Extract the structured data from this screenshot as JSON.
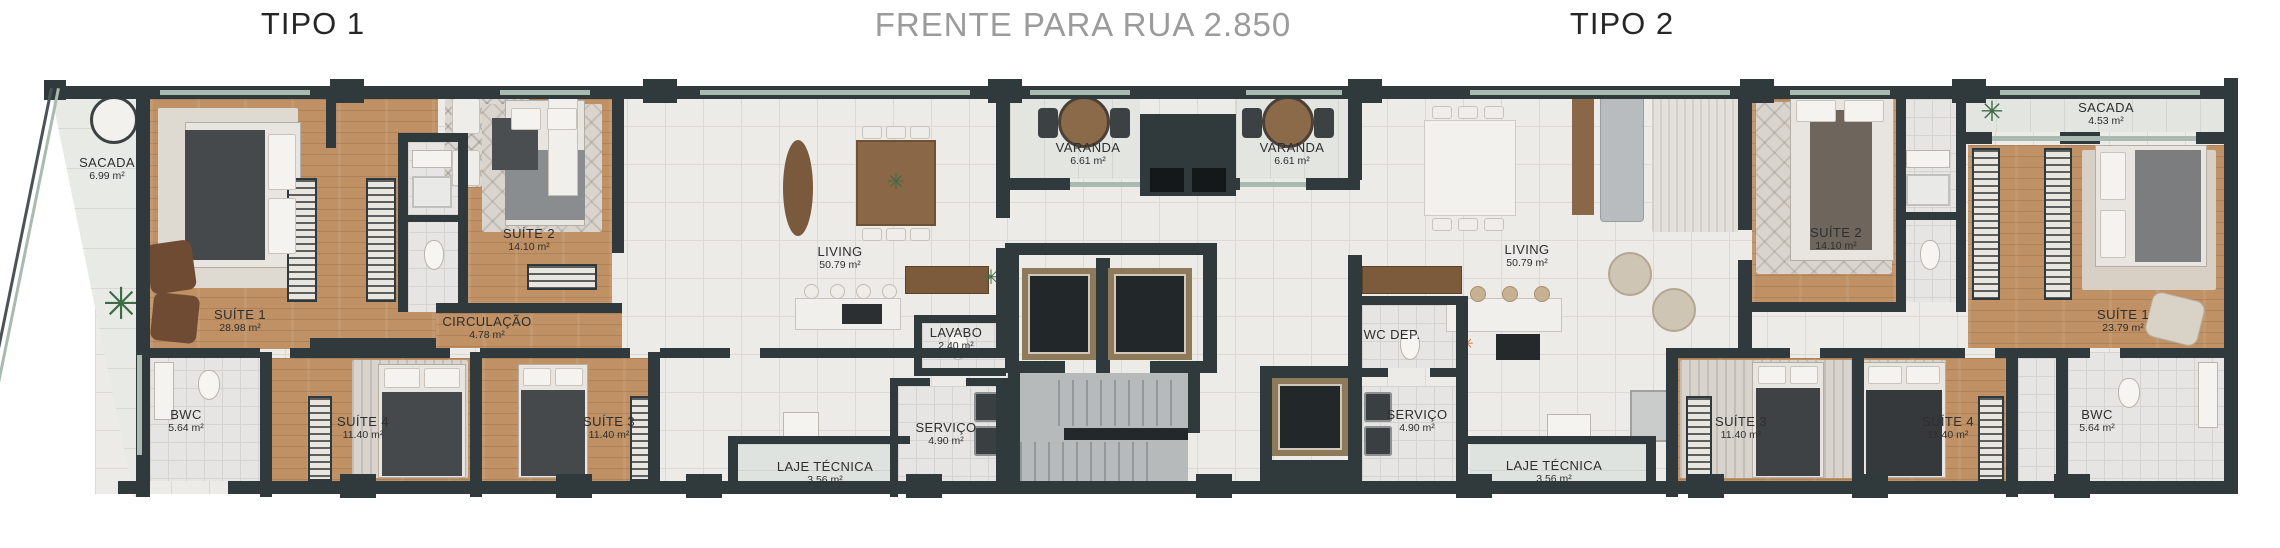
{
  "header": {
    "tipo1": "TIPO 1",
    "street_front": "FRENTE PARA RUA 2.850",
    "tipo2": "TIPO 2"
  },
  "colors": {
    "wall": "#303a3c",
    "wood_floor": "#bf9164",
    "tile_floor": "#ecebe8",
    "elevator_frame_bronze": "#8e7a5a",
    "glass": "#a9bbb1",
    "title_dark": "#262626",
    "title_gray": "#9b9b9b"
  },
  "unit_left": {
    "title": "TIPO 1",
    "rooms": {
      "sacada": {
        "label": "SACADA",
        "area": "6.99 m²"
      },
      "suite1": {
        "label": "SUÍTE 1",
        "area": "28.98 m²"
      },
      "suite2": {
        "label": "SUÍTE 2",
        "area": "14.10 m²"
      },
      "circulacao": {
        "label": "CIRCULAÇÃO",
        "area": "4.78 m²"
      },
      "bwc": {
        "label": "BWC",
        "area": "5.64 m²"
      },
      "suite4": {
        "label": "SUÍTE 4",
        "area": "11.40 m²"
      },
      "suite3": {
        "label": "SUÍTE 3",
        "area": "11.40 m²"
      },
      "living": {
        "label": "LIVING",
        "area": "50.79 m²"
      },
      "lavabo": {
        "label": "LAVABO",
        "area": "2.40 m²"
      },
      "servico": {
        "label": "SERVIÇO",
        "area": "4.90 m²"
      },
      "laje": {
        "label": "LAJE TÉCNICA",
        "area": "3.56 m²"
      },
      "varanda": {
        "label": "VARANDA",
        "area": "6.61 m²"
      }
    }
  },
  "unit_right": {
    "title": "TIPO 2",
    "rooms": {
      "varanda": {
        "label": "VARANDA",
        "area": "6.61 m²"
      },
      "living": {
        "label": "LIVING",
        "area": "50.79 m²"
      },
      "wc_dep": {
        "label": "WC DEP.",
        "area": ""
      },
      "servico": {
        "label": "SERVIÇO",
        "area": "4.90 m²"
      },
      "laje": {
        "label": "LAJE TÉCNICA",
        "area": "3.56 m²"
      },
      "suite2": {
        "label": "SUÍTE 2",
        "area": "14.10 m²"
      },
      "sacada": {
        "label": "SACADA",
        "area": "4.53 m²"
      },
      "suite1": {
        "label": "SUÍTE 1",
        "area": "23.79 m²"
      },
      "suite3": {
        "label": "SUÍTE 3",
        "area": "11.40 m²"
      },
      "suite4": {
        "label": "SUÍTE 4",
        "area": "11.40 m²"
      },
      "bwc": {
        "label": "BWC",
        "area": "5.64 m²"
      }
    }
  }
}
